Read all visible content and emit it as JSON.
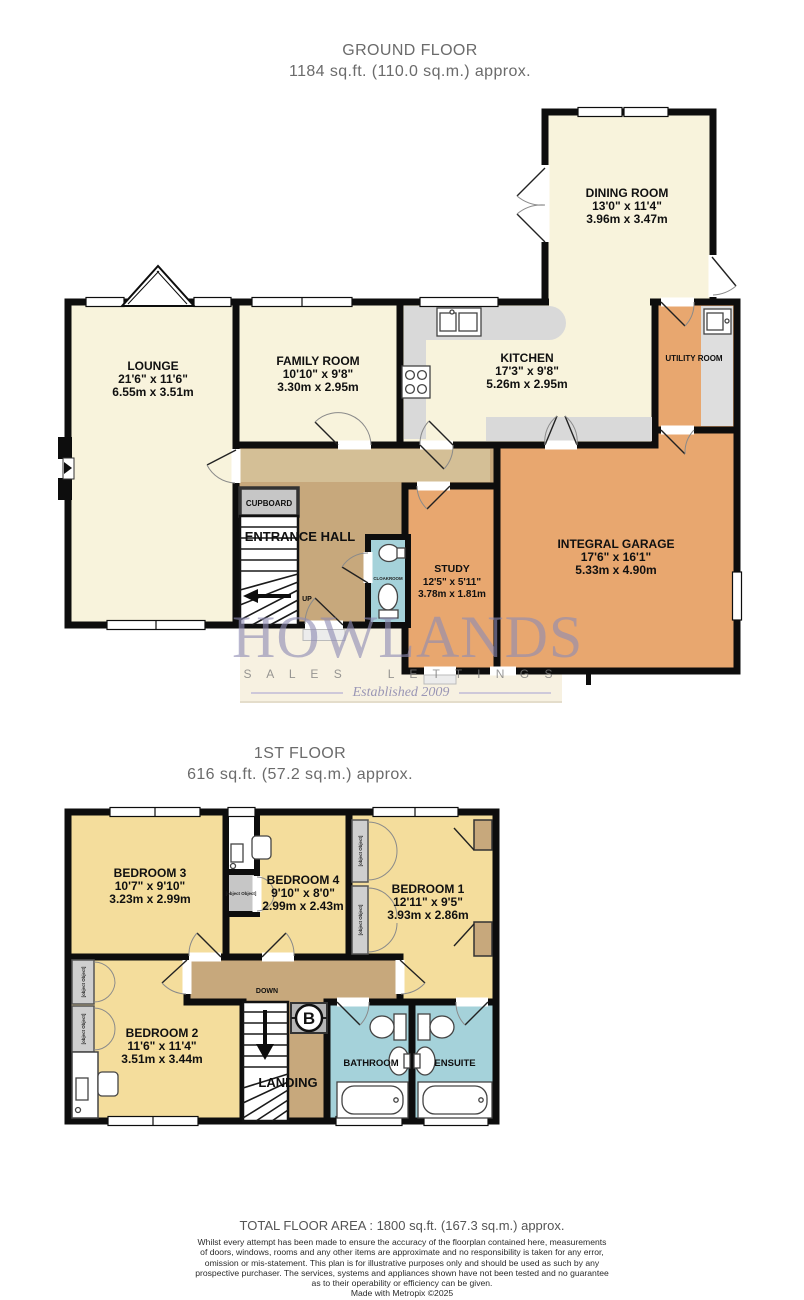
{
  "ground_floor": {
    "title": "GROUND FLOOR",
    "subtitle": "1184 sq.ft. (110.0 sq.m.) approx.",
    "rooms": {
      "lounge": {
        "name": "LOUNGE",
        "imperial": "21'6\" x 11'6\"",
        "metric": "6.55m x 3.51m"
      },
      "family_room": {
        "name": "FAMILY ROOM",
        "imperial": "10'10\" x 9'8\"",
        "metric": "3.30m x 2.95m"
      },
      "kitchen": {
        "name": "KITCHEN",
        "imperial": "17'3\" x 9'8\"",
        "metric": "5.26m x 2.95m"
      },
      "dining_room": {
        "name": "DINING ROOM",
        "imperial": "13'0\" x 11'4\"",
        "metric": "3.96m x 3.47m"
      },
      "study": {
        "name": "STUDY",
        "imperial": "12'5\" x 5'11\"",
        "metric": "3.78m x 1.81m"
      },
      "integral_garage": {
        "name": "INTEGRAL GARAGE",
        "imperial": "17'6\" x 16'1\"",
        "metric": "5.33m x 4.90m"
      },
      "utility_room": {
        "name": "UTILITY ROOM"
      },
      "entrance_hall": {
        "name": "ENTRANCE HALL"
      },
      "cupboard": {
        "name": "CUPBOARD"
      },
      "cloakroom": {
        "name": "CLOAKROOM"
      },
      "up_label": "UP"
    }
  },
  "first_floor": {
    "title": "1ST FLOOR",
    "subtitle": "616 sq.ft. (57.2 sq.m.) approx.",
    "rooms": {
      "bedroom1": {
        "name": "BEDROOM 1",
        "imperial": "12'11\" x 9'5\"",
        "metric": "3.93m x 2.86m"
      },
      "bedroom2": {
        "name": "BEDROOM 2",
        "imperial": "11'6\" x 11'4\"",
        "metric": "3.51m x 3.44m"
      },
      "bedroom3": {
        "name": "BEDROOM 3",
        "imperial": "10'7\" x 9'10\"",
        "metric": "3.23m x 2.99m"
      },
      "bedroom4": {
        "name": "BEDROOM 4",
        "imperial": "9'10\" x 8'0\"",
        "metric": "2.99m x 2.43m"
      },
      "landing": {
        "name": "LANDING"
      },
      "bathroom": {
        "name": "BATHROOM"
      },
      "ensuite": {
        "name": "ENSUITE"
      },
      "cupboard": {
        "name": "CUPBOARD"
      },
      "down_label": "DOWN",
      "boiler_label": "B"
    }
  },
  "watermark": {
    "name": "HOWLANDS",
    "sales": "S A L E S",
    "lettings": "L E T T I N G S",
    "established": "Established 2009"
  },
  "footer": {
    "total": "TOTAL FLOOR AREA : 1800 sq.ft. (167.3 sq.m.) approx.",
    "disclaimer": [
      "Whilst every attempt has been made to ensure the accuracy of the floorplan contained here, measurements",
      "of doors, windows, rooms and any other items are approximate and no responsibility is taken for any error,",
      "omission or mis-statement. This plan is for illustrative purposes only and should be used as such by any",
      "prospective purchaser. The services, systems and appliances shown have not been tested and no guarantee",
      "as to their operability or efficiency can be given."
    ],
    "credit": "Made with Metropix ©2025"
  },
  "colors": {
    "walls": "#0d0d0d",
    "cream_room": "#f8f3dc",
    "bedroom_yellow": "#f4dd9c",
    "garage_orange": "#e8a76f",
    "hall_tan": "#c7a87c",
    "bathroom_blue": "#a5d2da",
    "counter_gray": "#d9d9d9",
    "watermark_purple": "#8f8cb4"
  }
}
